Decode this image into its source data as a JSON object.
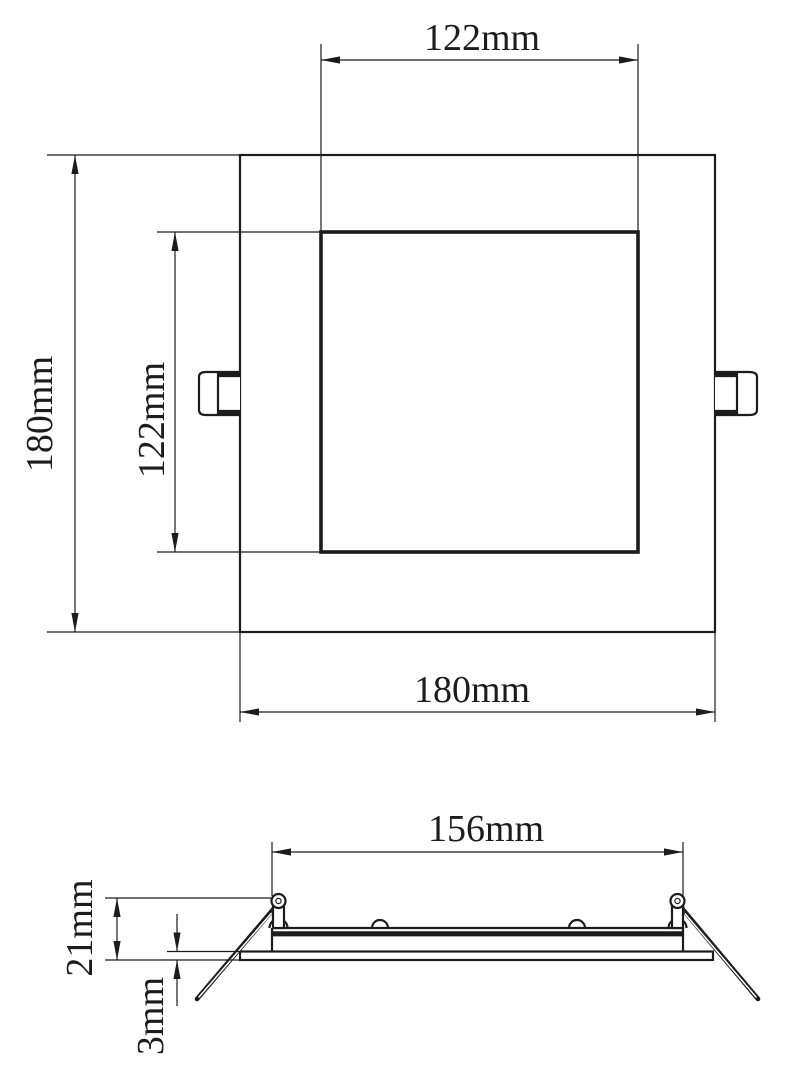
{
  "drawing": {
    "type": "technical-dimension-drawing",
    "subject": "square-recessed-panel-light",
    "colors": {
      "line": "#1c1c1c",
      "background": "#ffffff"
    },
    "top_view": {
      "cutout_width_label": "122mm",
      "panel_height_label": "180mm",
      "cutout_height_label": "122mm",
      "panel_width_label": "180mm"
    },
    "side_view": {
      "body_width_label": "156mm",
      "depth_label": "21mm",
      "flange_thickness_label": "3mm"
    }
  }
}
